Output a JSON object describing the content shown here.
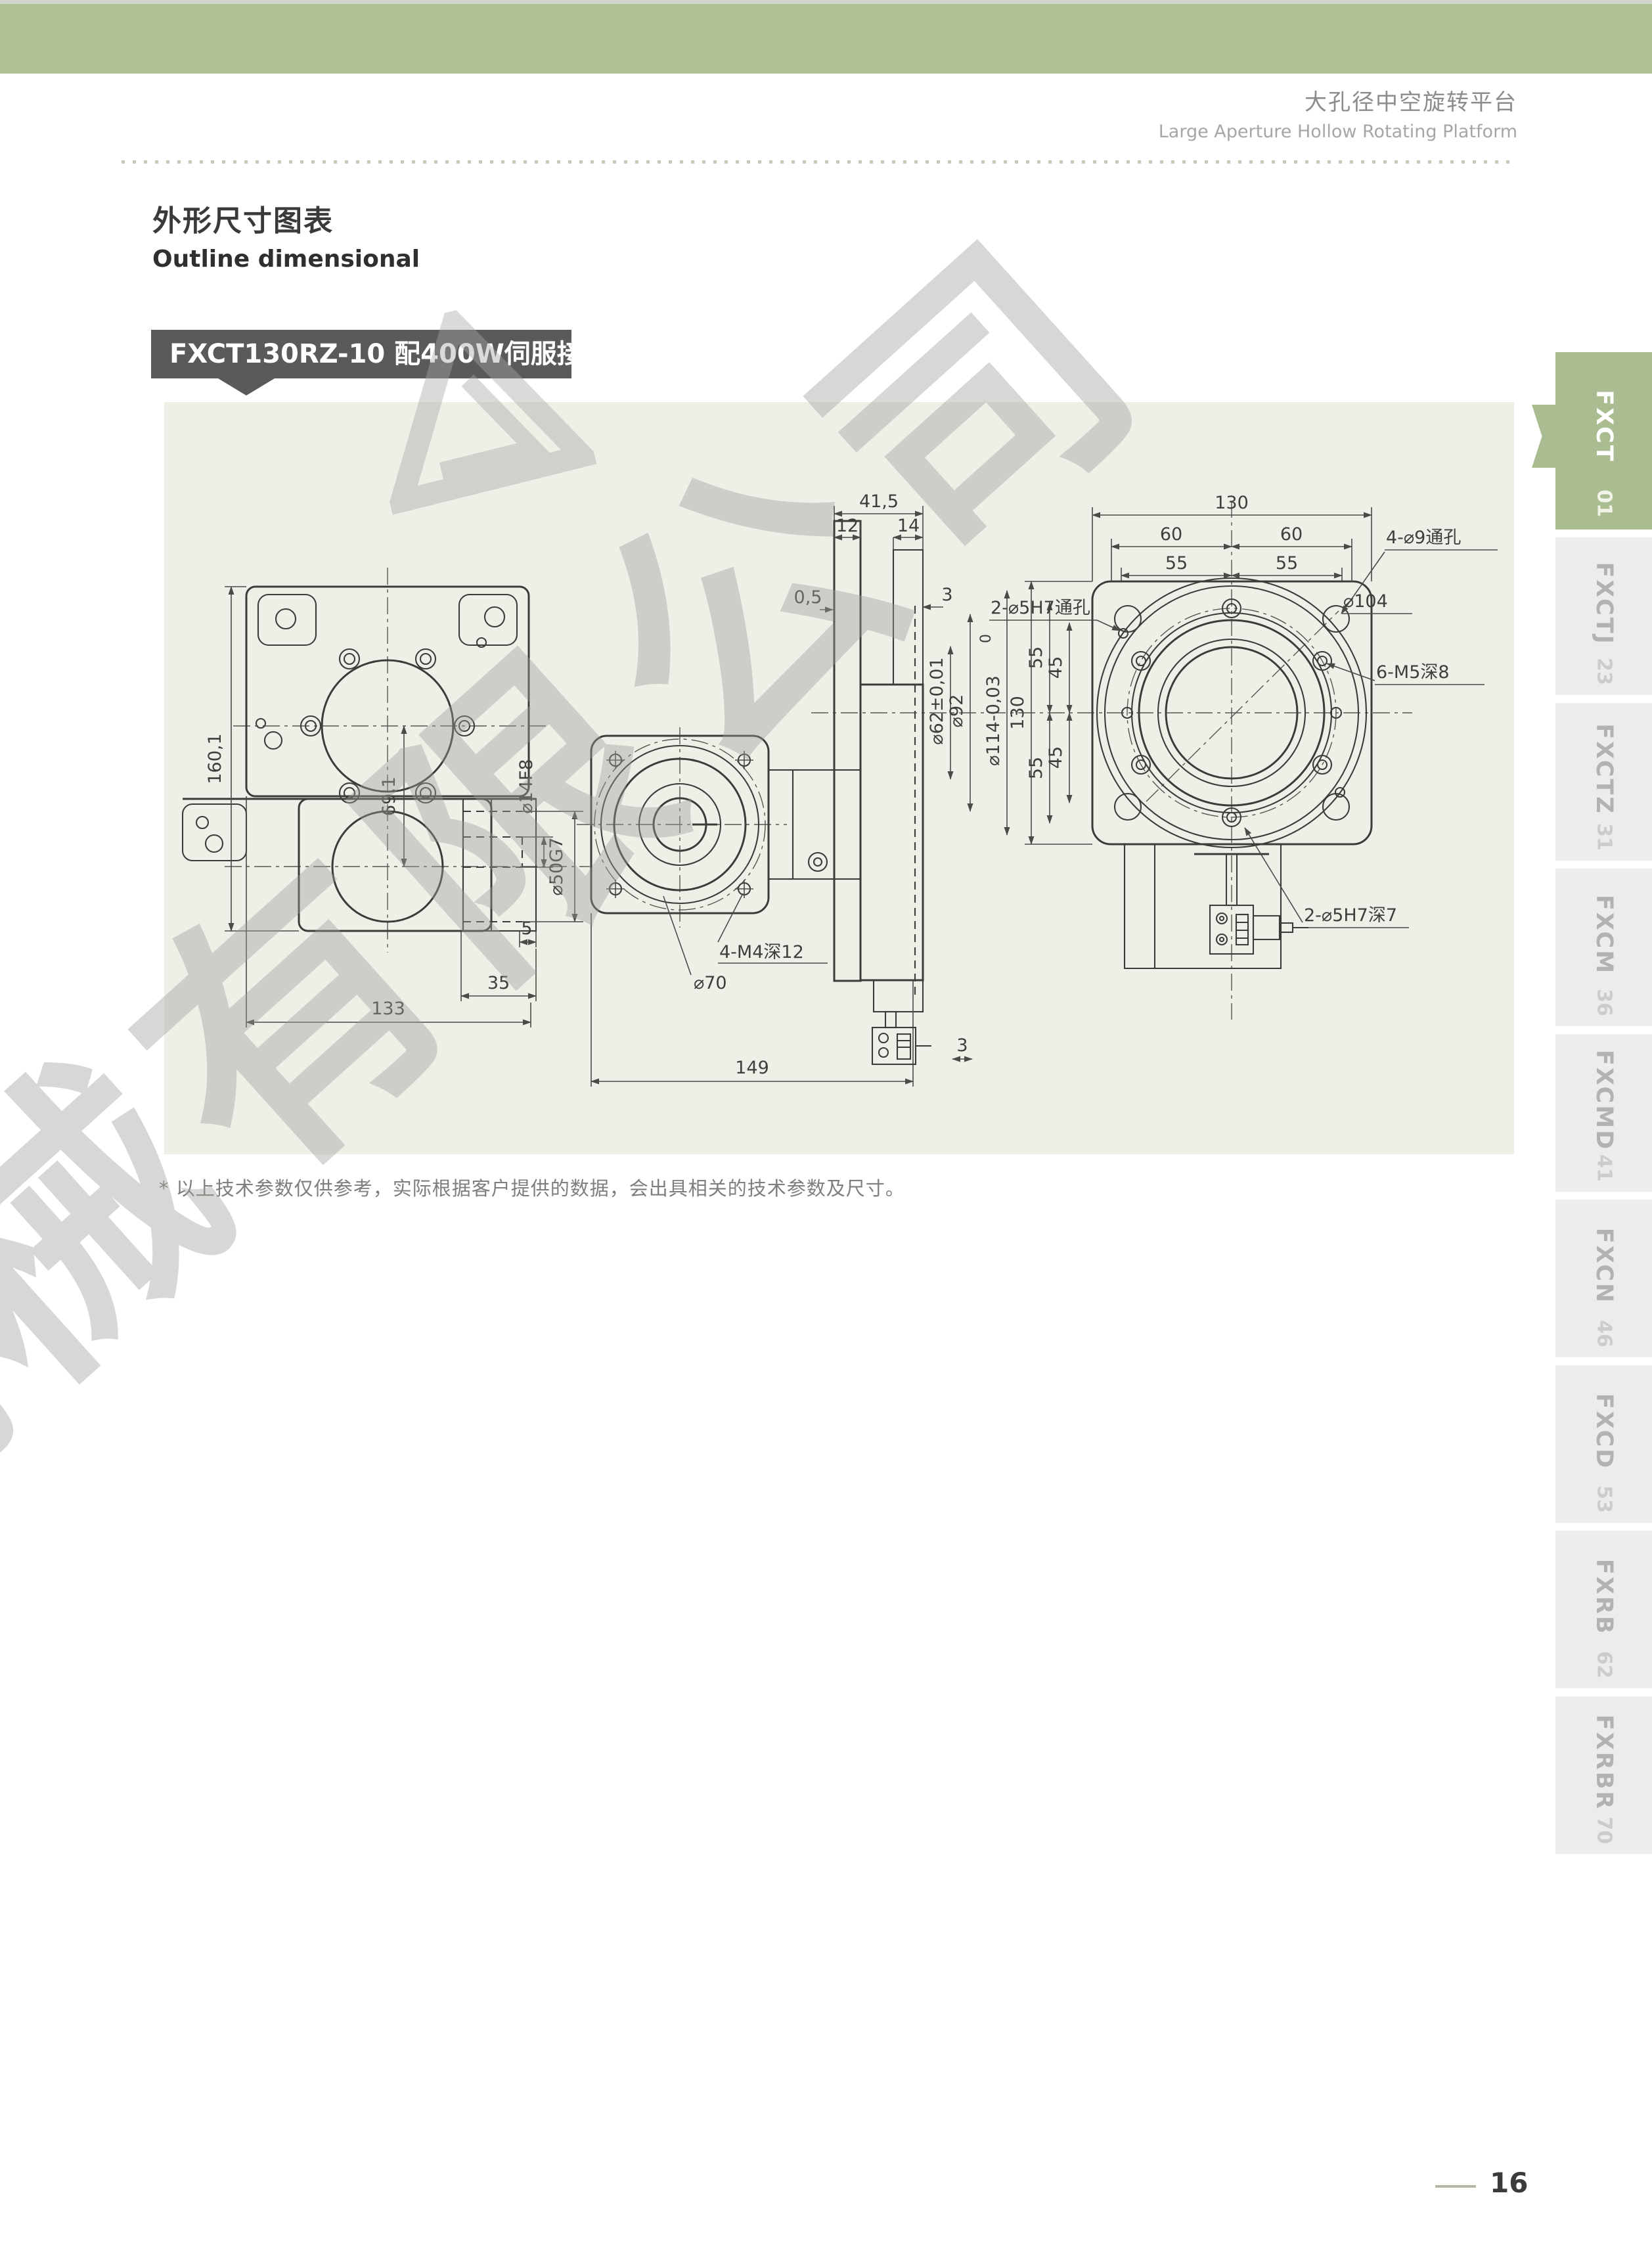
{
  "page": {
    "header": {
      "title_zh": "大孔径中空旋转平台",
      "title_en": "Large Aperture Hollow Rotating Platform"
    },
    "section_title_zh": "外形尺寸图表",
    "section_title_en": "Outline dimensional",
    "model_label": "FXCT130RZ-10 配400W伺服接口",
    "footnote": "* 以上技术参数仅供参考，实际根据客户提供的数据，会出具相关的技术参数及尺寸。",
    "page_number": "16",
    "watermark_text": "机械有限公司"
  },
  "sidebar": {
    "tabs": [
      {
        "label": "FXCT",
        "page": "01",
        "active": true
      },
      {
        "label": "FXCTJ",
        "page": "23",
        "active": false
      },
      {
        "label": "FXCTZ",
        "page": "31",
        "active": false
      },
      {
        "label": "FXCM",
        "page": "36",
        "active": false
      },
      {
        "label": "FXCMD",
        "page": "41",
        "active": false
      },
      {
        "label": "FXCN",
        "page": "46",
        "active": false
      },
      {
        "label": "FXCD",
        "page": "53",
        "active": false
      },
      {
        "label": "FXRB",
        "page": "62",
        "active": false
      },
      {
        "label": "FXRBR",
        "page": "70",
        "active": false
      }
    ]
  },
  "drawing": {
    "colors": {
      "panel_bg": "#eef0e8",
      "line": "#3b3b39",
      "accent_green": "#a9bd90"
    },
    "labels": {
      "tv_160": "160,1",
      "tv_69": "69,1",
      "tv_d14": "⌀14F8",
      "tv_d50": "⌀50G7",
      "tv_5": "5",
      "tv_35": "35",
      "tv_133": "133",
      "sv_415": "41,5",
      "sv_12": "12",
      "sv_14": "14",
      "sv_05": "0,5",
      "sv_3t": "3",
      "sv_d62": "⌀62±0,01",
      "sv_d92": "⌀92",
      "sv_0": "0",
      "sv_d114": "⌀114-0,03",
      "sv_m4": "4-M4深12",
      "sv_d70": "⌀70",
      "sv_149": "149",
      "sv_3b": "3",
      "rv_130t": "130",
      "rv_60a": "60",
      "rv_60b": "60",
      "rv_55a": "55",
      "rv_55b": "55",
      "rv_130l": "130",
      "rv_55c": "55",
      "rv_45a": "45",
      "rv_45b": "45",
      "rv_55d": "55",
      "rv_d104": "⌀104",
      "rv_m5": "6-M5深8",
      "rv_d9": "4-⌀9通孔",
      "rv_pin_t": "2-⌀5H7通孔",
      "rv_pin_b": "2-⌀5H7深7"
    }
  }
}
